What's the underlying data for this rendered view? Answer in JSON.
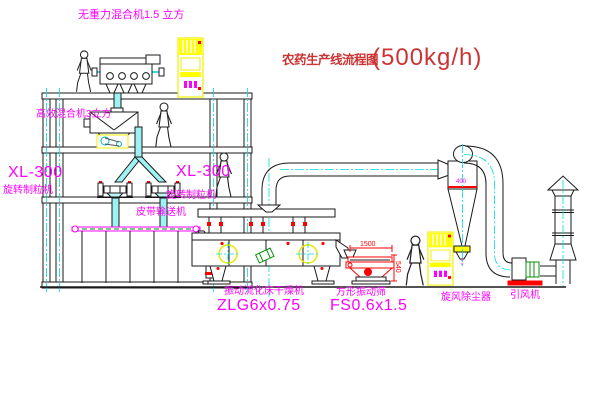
{
  "title": {
    "name_cn": "农药生产线流程图",
    "capacity": "(500kg/h)"
  },
  "labels": {
    "top_mixer": "无重力混合机1.5 立方",
    "floor2_mixer": "高效混合机3立方",
    "granulator_left_model": "XL-300",
    "granulator_left_name": "旋转制粒机",
    "granulator_mid_model": "XL-300",
    "granulator_mid_name": "旋转制粒机",
    "belt_conveyor": "皮带输送机",
    "dryer_name": "振动流化床干燥机",
    "dryer_model": "ZLG6x0.75",
    "sieve_name": "方形振动筛",
    "sieve_model": "FS0.6x1.5",
    "cyclone": "旋风除尘器",
    "fan": "引风机"
  },
  "dimensions": {
    "sieve_length": "1500",
    "sieve_height": "540",
    "cyclone_size": "400"
  },
  "colors": {
    "label_magenta": "#ff00ff",
    "title_red": "#cc3434",
    "centerline_cyan": "#00dcdc",
    "equipment_yellow": "#ffff00",
    "detail_red": "#ff0000",
    "detail_green": "#0a8f0a",
    "line_black": "#1a1a1a"
  }
}
